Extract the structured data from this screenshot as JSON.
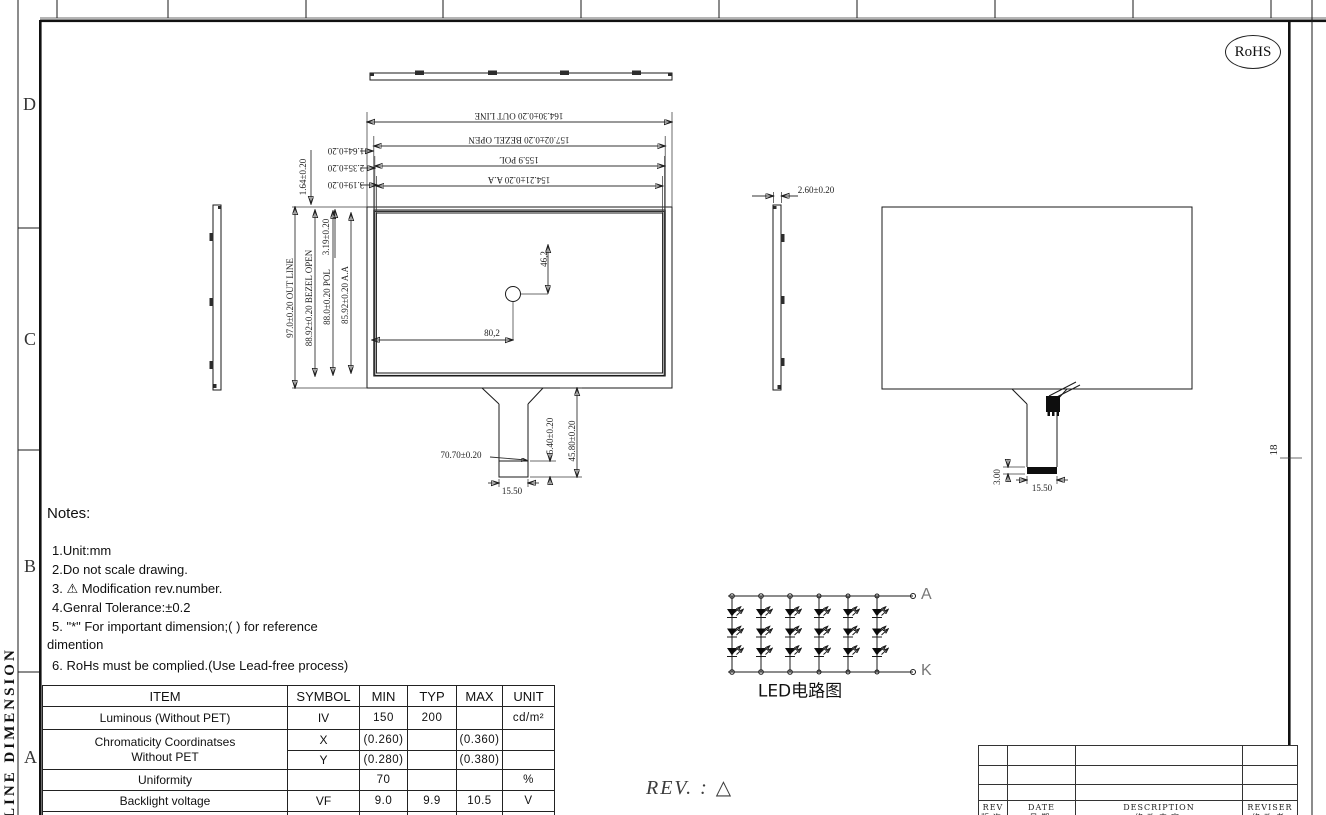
{
  "frame": {
    "zone_rows": [
      "D",
      "C",
      "B",
      "A"
    ],
    "side_title": "LINE DIMENSION",
    "right_zone_label": "18",
    "rohs_label": "RoHS"
  },
  "drawing": {
    "front_view": {
      "dim_outline_w": "164.30±0.20 OUT LINE",
      "dim_bezel_w": "157.02±0.20 BEZEL OPEN",
      "dim_pol_w": "155.9 POL",
      "dim_aa_w": "154.21±0.20 A.A",
      "dim_outline_h": "97.0±0.20 OUT LINE",
      "dim_bezel_h": "88.92±0.20 BEZEL OPEN",
      "dim_pol_h": "88.0±0.20 POL",
      "dim_aa_h": "85.92±0.20 A.A",
      "dim_top_gap1_v": "1.64±0.20",
      "dim_top_gap1": "1.64±0.20",
      "dim_top_gap2": "2.35±0.20",
      "dim_top_gap3": "3.19±0.20",
      "dim_top_gap3_v": "3.19±0.20",
      "dim_hole_x": "80,2",
      "dim_hole_y": "46,2",
      "dim_fpc_leader": "70.70±0.20",
      "dim_fpc_stiffener": "5.40±0.20",
      "dim_fpc_length": "45.80±0.20",
      "dim_fpc_width": "15.50"
    },
    "side_view": {
      "dim_thickness": "2.60±0.20"
    },
    "rear_view": {
      "dim_stiffener": "3.00",
      "dim_fpc_width": "15.50"
    }
  },
  "notes": {
    "title": "Notes:",
    "items": [
      "1.Unit:mm",
      "2.Do not scale drawing.",
      "3. ⚠  Modification rev.number.",
      "4.Genral Tolerance:±0.2",
      "5. \"*\" For important dimension;( ) for reference",
      "dimention",
      "6. RoHs must be complied.(Use Lead-free process)"
    ]
  },
  "spec_table": {
    "headers": [
      "ITEM",
      "SYMBOL",
      "MIN",
      "TYP",
      "MAX",
      "UNIT"
    ],
    "rows": [
      {
        "item": "Luminous (Without PET)",
        "symbol": "IV",
        "min": "150",
        "typ": "200",
        "max": "",
        "unit": "cd/m²"
      },
      {
        "item": "Chromaticity Coordinatses",
        "item2": "Without PET",
        "symbol": "X",
        "min": "(0.260)",
        "typ": "",
        "max": "(0.360)",
        "unit": ""
      },
      {
        "symbol": "Y",
        "min": "(0.280)",
        "typ": "",
        "max": "(0.380)",
        "unit": ""
      },
      {
        "item": "Uniformity",
        "symbol": "",
        "min": "70",
        "typ": "",
        "max": "",
        "unit": "%"
      },
      {
        "item": "Backlight voltage",
        "symbol": "VF",
        "min": "9.0",
        "typ": "9.9",
        "max": "10.5",
        "unit": "V"
      },
      {
        "item": "Backlight current",
        "symbol": "IF",
        "min": "",
        "typ": "120",
        "max": "",
        "unit": "mA"
      }
    ]
  },
  "led_circuit": {
    "caption": "LED电路图",
    "anode_label": "A",
    "cathode_label": "K",
    "strings": 6,
    "leds_per_string": 3
  },
  "rev_note": "REV. : △",
  "rev_table": {
    "headers_en": [
      "REV",
      "DATE",
      "DESCRIPTION",
      "REVISER"
    ],
    "headers_cn": [
      "版次",
      "日期",
      "修改内容",
      "修改者"
    ],
    "empty_rows": 3
  }
}
